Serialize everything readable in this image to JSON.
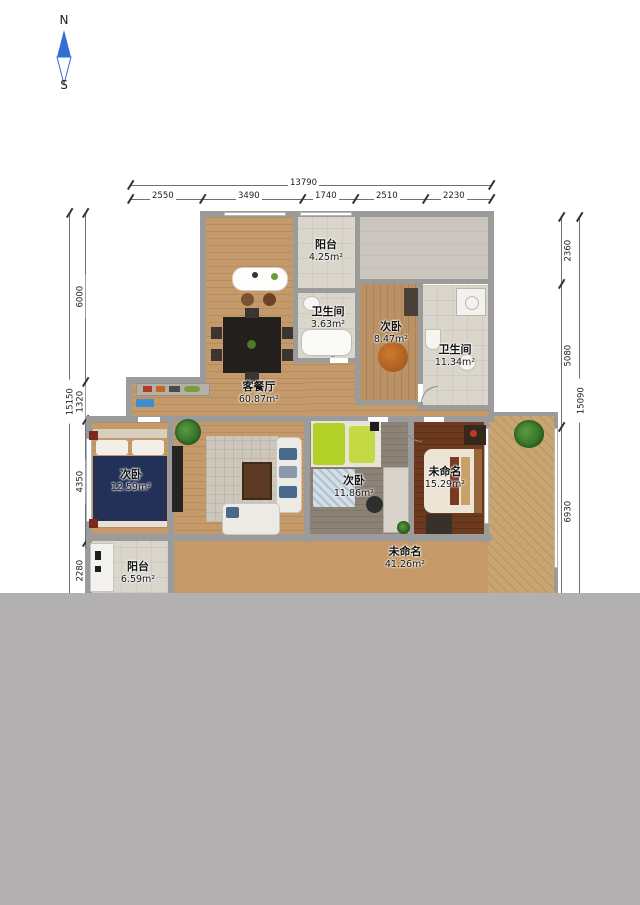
{
  "compass": {
    "north": "N",
    "south": "S"
  },
  "dimensions": {
    "top": {
      "total": "13790",
      "segments": [
        "2550",
        "3490",
        "1740",
        "2510",
        "2230"
      ]
    },
    "left": {
      "total": "15150",
      "segments": [
        "6000",
        "1320",
        "4350",
        "2280"
      ]
    },
    "right": {
      "total": "15090",
      "segments": [
        "2360",
        "5080",
        "6930"
      ]
    }
  },
  "rooms": {
    "balcony_top": {
      "name": "阳台",
      "area": "4.25m²"
    },
    "bathroom_small": {
      "name": "卫生间",
      "area": "3.63m²"
    },
    "bedroom_top": {
      "name": "次卧",
      "area": "8.47m²"
    },
    "bathroom_large": {
      "name": "卫生间",
      "area": "11.34m²"
    },
    "living_dining": {
      "name": "客餐厅",
      "area": "60.87m²"
    },
    "bedroom_left": {
      "name": "次卧",
      "area": "12.59m²"
    },
    "bedroom_middle": {
      "name": "次卧",
      "area": "11.86m²"
    },
    "bedroom_right": {
      "name": "未命名",
      "area": "15.29m²"
    },
    "balcony_bottom": {
      "name": "阳台",
      "area": "6.59m²"
    },
    "open_space": {
      "name": "未命名",
      "area": "41.26m²"
    }
  },
  "colors": {
    "wall_gray": "#9b9b9b",
    "wood_floor": "#c59a6a",
    "dark_bedroom_floor": "#6e3a1e",
    "gray_cover": "#b2b0b0",
    "compass_blue": "#2f6fd6",
    "bed_navy": "#233158",
    "bed_lime": "#b2d028"
  }
}
